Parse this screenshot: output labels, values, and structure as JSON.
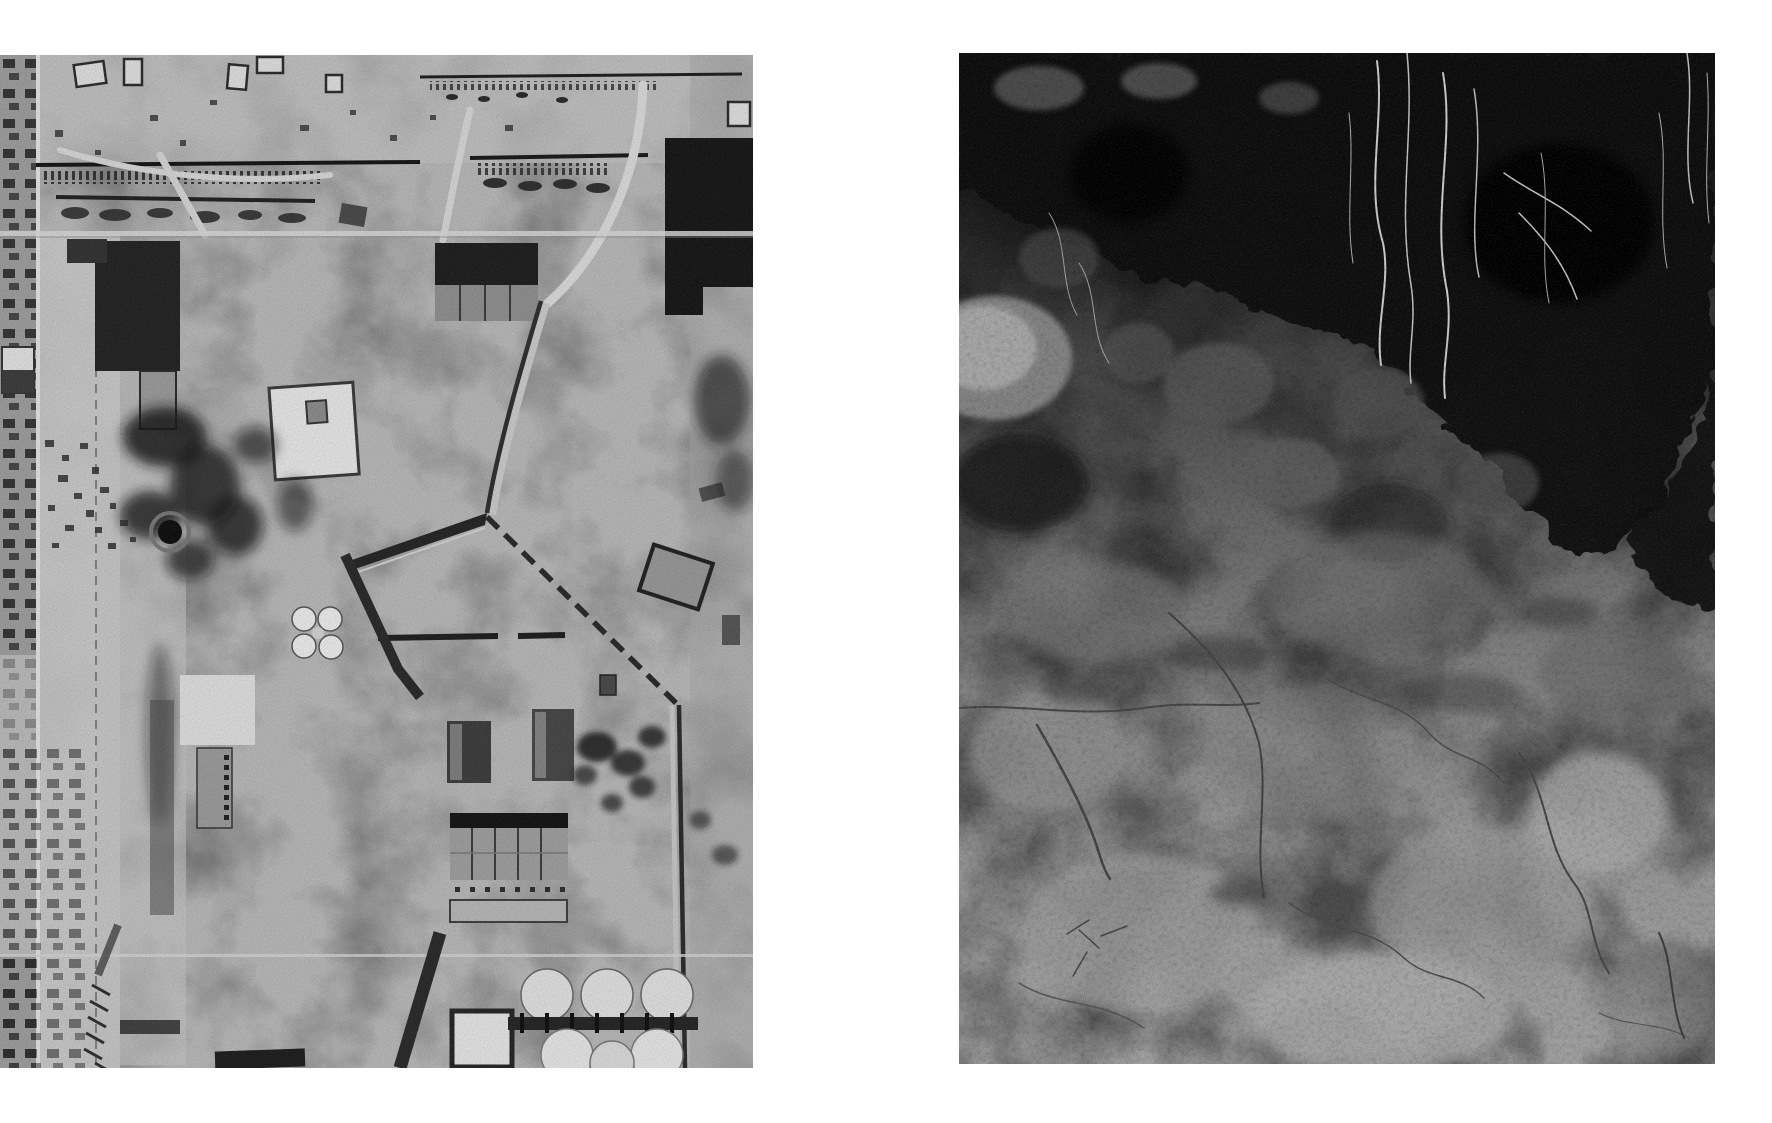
{
  "page": {
    "background_color": "#ffffff",
    "description": "Two black-and-white photographs reproduced side by side on a plain white page, no captions or text"
  },
  "images": [
    {
      "name": "aerial-photo",
      "description": "Black-and-white vertical aerial reconnaissance photograph of an industrial plant: railway sidings across the top, large dark factory buildings, a pale walled courtyard, bomb-darkened rubble ground, a V-shaped fenced road junction in the centre, barracks and a sawtooth-roofed factory hall lower right, rows of round white storage tanks at the bottom, and a strip of town blocks along the left edge",
      "orientation": "portrait",
      "palette": {
        "base": "#b4b4b4",
        "dark": "#1a1a1a",
        "light": "#e6e6e6"
      }
    },
    {
      "name": "soil-photo",
      "description": "Black-and-white close-up photograph of an excavated earth wall: near-black overhanging topsoil with fine pale roots hanging down at the top, a light boulder at the upper left, and rough cracked grey clay soil filling the lower two thirds",
      "orientation": "portrait",
      "palette": {
        "top": "#101010",
        "middle": "#7a7a7a",
        "bottom": "#a9a9a9"
      }
    }
  ]
}
